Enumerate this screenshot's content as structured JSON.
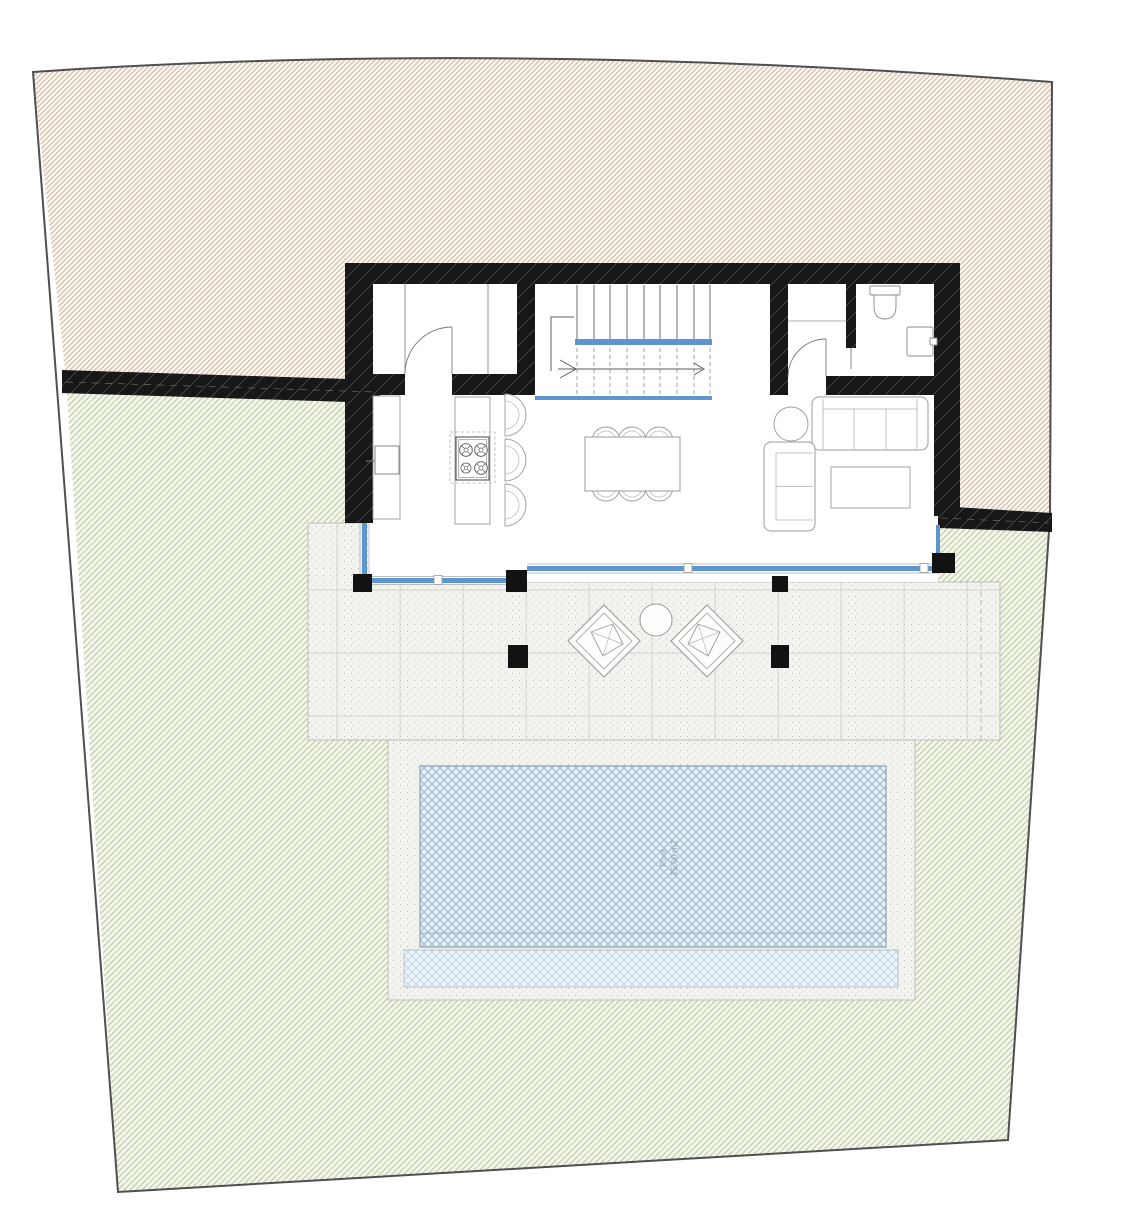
{
  "plan": {
    "pool_label_line1": "Pool",
    "pool_label_line2": "25.00 m2",
    "colors": {
      "wall_black": "#171717",
      "glass_blue": "#5d95cf",
      "upper_land_hatch": "#d7c5b1",
      "lower_land_hatch": "#c9d3b8",
      "pool_hatch": "#a9c0d2",
      "boundary_line": "#4f4f4f"
    }
  }
}
